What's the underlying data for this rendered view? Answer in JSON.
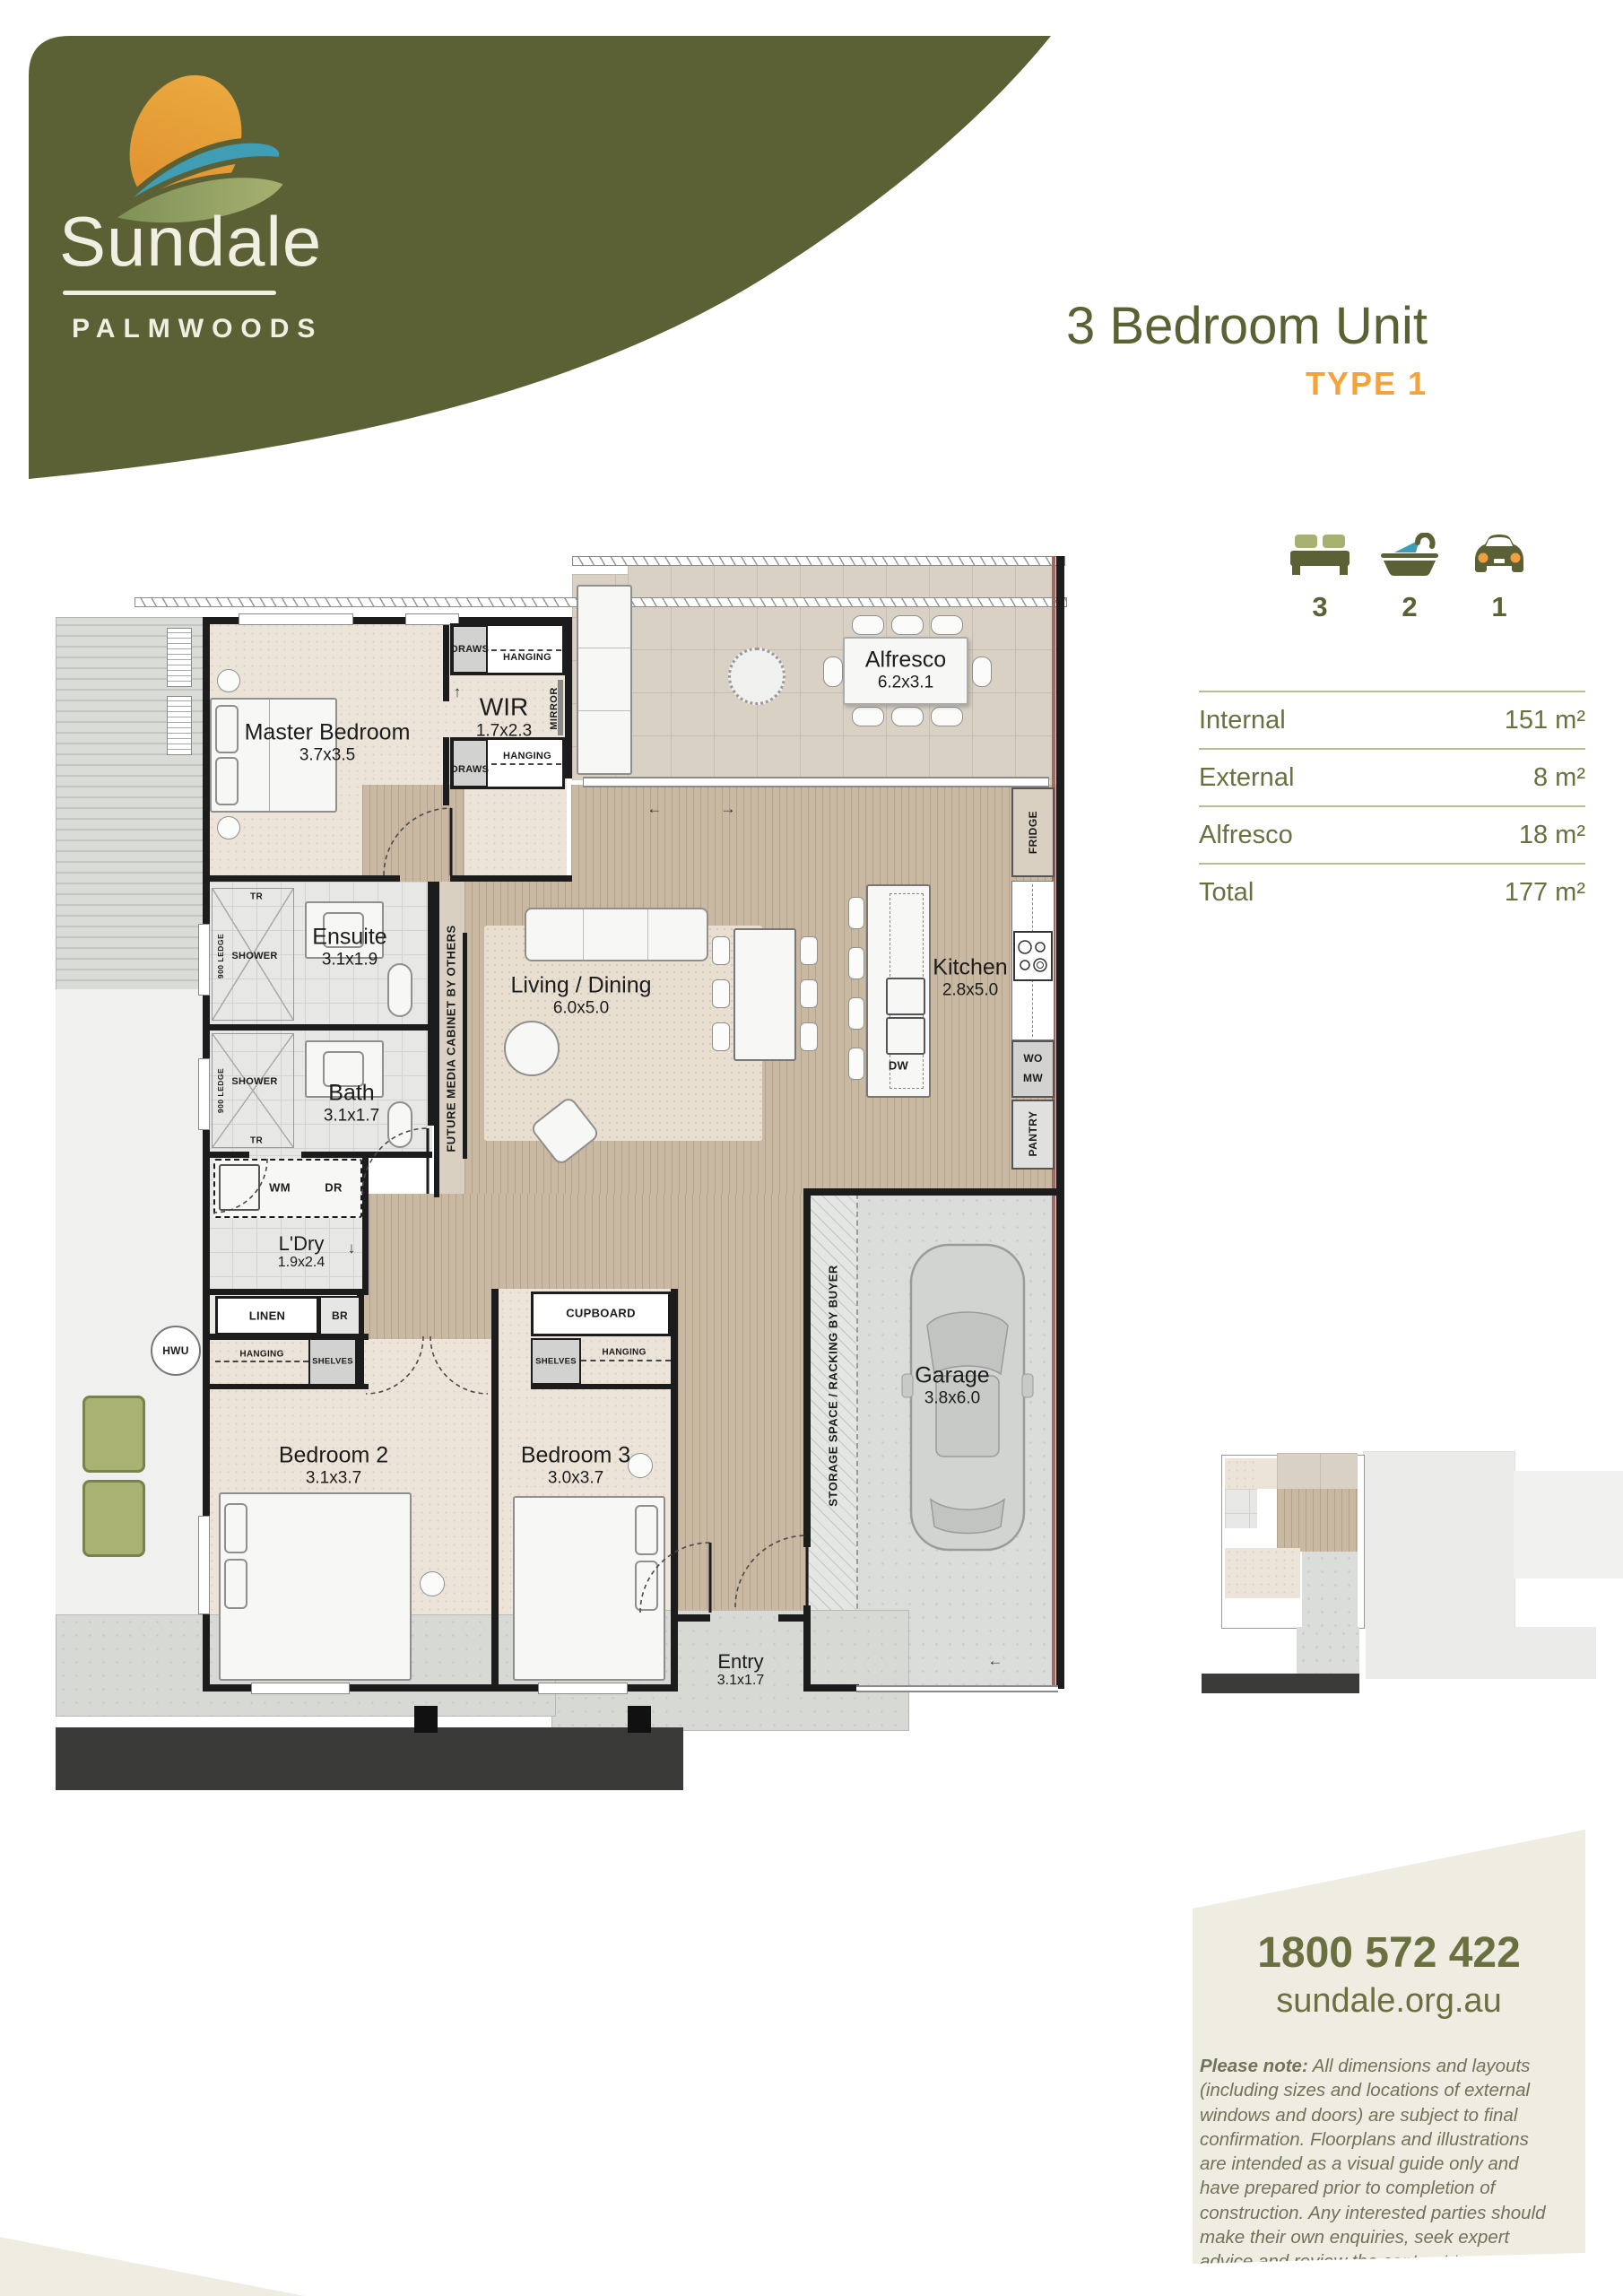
{
  "brand": {
    "name": "Sundale",
    "location": "PALMWOODS"
  },
  "header": {
    "title": "3 Bedroom Unit",
    "type": "TYPE 1"
  },
  "features": [
    {
      "icon": "bed-icon",
      "count": "3"
    },
    {
      "icon": "bath-icon",
      "count": "2"
    },
    {
      "icon": "car-icon",
      "count": "1"
    }
  ],
  "areas": [
    {
      "label": "Internal",
      "value": "151 m²"
    },
    {
      "label": "External",
      "value": "8 m²"
    },
    {
      "label": "Alfresco",
      "value": "18 m²"
    },
    {
      "label": "Total",
      "value": "177 m²"
    }
  ],
  "rooms": {
    "master": {
      "name": "Master Bedroom",
      "size": "3.7x3.5"
    },
    "wir": {
      "name": "WIR",
      "size": "1.7x2.3"
    },
    "alfresco": {
      "name": "Alfresco",
      "size": "6.2x3.1"
    },
    "ensuite": {
      "name": "Ensuite",
      "size": "3.1x1.9"
    },
    "bath": {
      "name": "Bath",
      "size": "3.1x1.7"
    },
    "living": {
      "name": "Living / Dining",
      "size": "6.0x5.0"
    },
    "kitchen": {
      "name": "Kitchen",
      "size": "2.8x5.0"
    },
    "ldry": {
      "name": "L'Dry",
      "size": "1.9x2.4"
    },
    "bed2": {
      "name": "Bedroom 2",
      "size": "3.1x3.7"
    },
    "bed3": {
      "name": "Bedroom 3",
      "size": "3.0x3.7"
    },
    "garage": {
      "name": "Garage",
      "size": "3.8x6.0"
    },
    "entry": {
      "name": "Entry",
      "size": "3.1x1.7"
    }
  },
  "plan_labels": {
    "draws": "DRAWS",
    "hanging": "HANGING",
    "mirror": "MIRROR",
    "fridge": "FRIDGE",
    "shower": "SHOWER",
    "tr": "TR",
    "ledge": "900 LEDGE",
    "wm": "WM",
    "dr": "DR",
    "linen": "LINEN",
    "br": "BR",
    "hwu": "HWU",
    "shelves": "SHELVES",
    "cupboard": "CUPBOARD",
    "dw": "DW",
    "wo": "WO",
    "mw": "MW",
    "pantry": "PANTRY",
    "media": "FUTURE MEDIA CABINET BY OTHERS",
    "storage": "STORAGE SPACE / RACKING BY BUYER"
  },
  "footer": {
    "phone": "1800 572 422",
    "website": "sundale.org.au",
    "note_label": "Please note:",
    "note_text": " All dimensions and layouts (including sizes and locations of external windows and doors) are subject to final confirmation. Floorplans and illustrations are intended as a visual guide only and have prepared prior to completion of construction. Any interested parties should make their own enquiries, seek expert advice and review the contract terms as to the accuracy of the information."
  },
  "colors": {
    "olive": "#5c6135",
    "orange": "#f2a33c",
    "cream": "#efece1",
    "teal": "#3f9db5",
    "text_olive": "#6b7040"
  }
}
